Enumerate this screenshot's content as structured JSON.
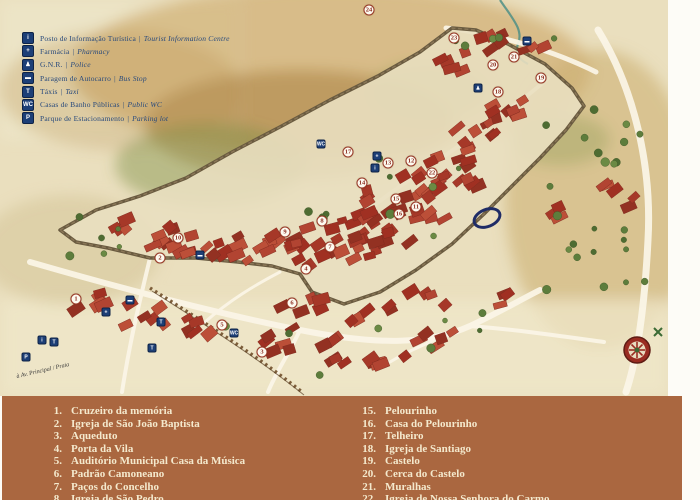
{
  "colors": {
    "band_background": "#aa6740",
    "band_text": "#f4e9cd",
    "legend_text": "#27497c",
    "icon_background": "#1d3f77",
    "marker_number": "#8c2f22",
    "parchment": "#eadfbe",
    "roof_red": "#a63828",
    "highlight_ring": "#1f2c66"
  },
  "legend": {
    "items": [
      {
        "icon": "tourist-info-icon",
        "glyph": "i",
        "pt": "Posto de Informação Turística",
        "en": "Tourist Information Centre"
      },
      {
        "icon": "pharmacy-icon",
        "glyph": "+",
        "pt": "Farmácia",
        "en": "Pharmacy"
      },
      {
        "icon": "police-icon",
        "glyph": "♟",
        "pt": "G.N.R.",
        "en": "Police"
      },
      {
        "icon": "bus-stop-icon",
        "glyph": "▬",
        "pt": "Paragem de Autocarro",
        "en": "Bus Stop"
      },
      {
        "icon": "taxi-icon",
        "glyph": "T",
        "pt": "Táxis",
        "en": "Taxi"
      },
      {
        "icon": "public-wc-icon",
        "glyph": "WC",
        "pt": "Casas de Banho Públicas",
        "en": "Public WC"
      },
      {
        "icon": "parking-icon",
        "glyph": "P",
        "pt": "Parque de Estacionamento",
        "en": "Parking lot"
      }
    ],
    "separator": "|"
  },
  "map": {
    "annotation": "à Av. Principal / Praia",
    "markers": [
      {
        "n": "1",
        "x": 76,
        "y": 299
      },
      {
        "n": "2",
        "x": 160,
        "y": 258
      },
      {
        "n": "3",
        "x": 262,
        "y": 352
      },
      {
        "n": "4",
        "x": 306,
        "y": 269
      },
      {
        "n": "5",
        "x": 222,
        "y": 325
      },
      {
        "n": "6",
        "x": 292,
        "y": 303
      },
      {
        "n": "7",
        "x": 330,
        "y": 247
      },
      {
        "n": "8",
        "x": 322,
        "y": 221
      },
      {
        "n": "9",
        "x": 285,
        "y": 232
      },
      {
        "n": "10",
        "x": 178,
        "y": 238
      },
      {
        "n": "11",
        "x": 416,
        "y": 207
      },
      {
        "n": "12",
        "x": 411,
        "y": 161
      },
      {
        "n": "13",
        "x": 388,
        "y": 163
      },
      {
        "n": "14",
        "x": 362,
        "y": 183
      },
      {
        "n": "15",
        "x": 396,
        "y": 199
      },
      {
        "n": "16",
        "x": 399,
        "y": 214
      },
      {
        "n": "17",
        "x": 348,
        "y": 152
      },
      {
        "n": "18",
        "x": 498,
        "y": 92
      },
      {
        "n": "19",
        "x": 541,
        "y": 78
      },
      {
        "n": "20",
        "x": 493,
        "y": 65
      },
      {
        "n": "21",
        "x": 514,
        "y": 57
      },
      {
        "n": "22",
        "x": 432,
        "y": 173
      },
      {
        "n": "23",
        "x": 454,
        "y": 38
      },
      {
        "n": "24",
        "x": 369,
        "y": 10
      }
    ],
    "icons": [
      {
        "type": "bus-stop-icon",
        "glyph": "▬",
        "x": 527,
        "y": 41
      },
      {
        "type": "police-icon",
        "glyph": "♟",
        "x": 478,
        "y": 88
      },
      {
        "type": "public-wc-icon",
        "glyph": "WC",
        "x": 321,
        "y": 144
      },
      {
        "type": "pharmacy-icon",
        "glyph": "+",
        "x": 377,
        "y": 156
      },
      {
        "type": "tourist-info-icon",
        "glyph": "i",
        "x": 375,
        "y": 168
      },
      {
        "type": "bus-stop-icon",
        "glyph": "▬",
        "x": 200,
        "y": 255
      },
      {
        "type": "bus-stop-icon",
        "glyph": "▬",
        "x": 130,
        "y": 300
      },
      {
        "type": "pharmacy-icon",
        "glyph": "+",
        "x": 106,
        "y": 312
      },
      {
        "type": "taxi-icon",
        "glyph": "T",
        "x": 161,
        "y": 322
      },
      {
        "type": "public-wc-icon",
        "glyph": "WC",
        "x": 234,
        "y": 333
      },
      {
        "type": "taxi-icon",
        "glyph": "T",
        "x": 152,
        "y": 348
      },
      {
        "type": "tourist-info-icon",
        "glyph": "i",
        "x": 42,
        "y": 340
      },
      {
        "type": "taxi-icon",
        "glyph": "T",
        "x": 54,
        "y": 342
      },
      {
        "type": "parking-icon",
        "glyph": "P",
        "x": 26,
        "y": 357
      }
    ]
  },
  "landmarks": {
    "left": [
      {
        "num": "1.",
        "label": "Cruzeiro da memória"
      },
      {
        "num": "2.",
        "label": "Igreja de São João Baptista"
      },
      {
        "num": "3.",
        "label": "Aqueduto"
      },
      {
        "num": "4.",
        "label": "Porta da Vila"
      },
      {
        "num": "5.",
        "label": "Auditório Municipal Casa da Música"
      },
      {
        "num": "6.",
        "label": "Padrão Camoneano"
      },
      {
        "num": "7.",
        "label": "Paços do Concelho"
      },
      {
        "num": "8.",
        "label": "Igreja de São Pedro"
      }
    ],
    "right": [
      {
        "num": "15.",
        "label": "Pelourinho"
      },
      {
        "num": "16.",
        "label": "Casa do Pelourinho"
      },
      {
        "num": "17.",
        "label": "Telheiro"
      },
      {
        "num": "18.",
        "label": "Igreja de Santiago"
      },
      {
        "num": "19.",
        "label": "Castelo"
      },
      {
        "num": "20.",
        "label": "Cerca do Castelo"
      },
      {
        "num": "21.",
        "label": "Muralhas"
      },
      {
        "num": "22.",
        "label": "Igreja de Nossa Senhora do Carmo"
      }
    ]
  }
}
